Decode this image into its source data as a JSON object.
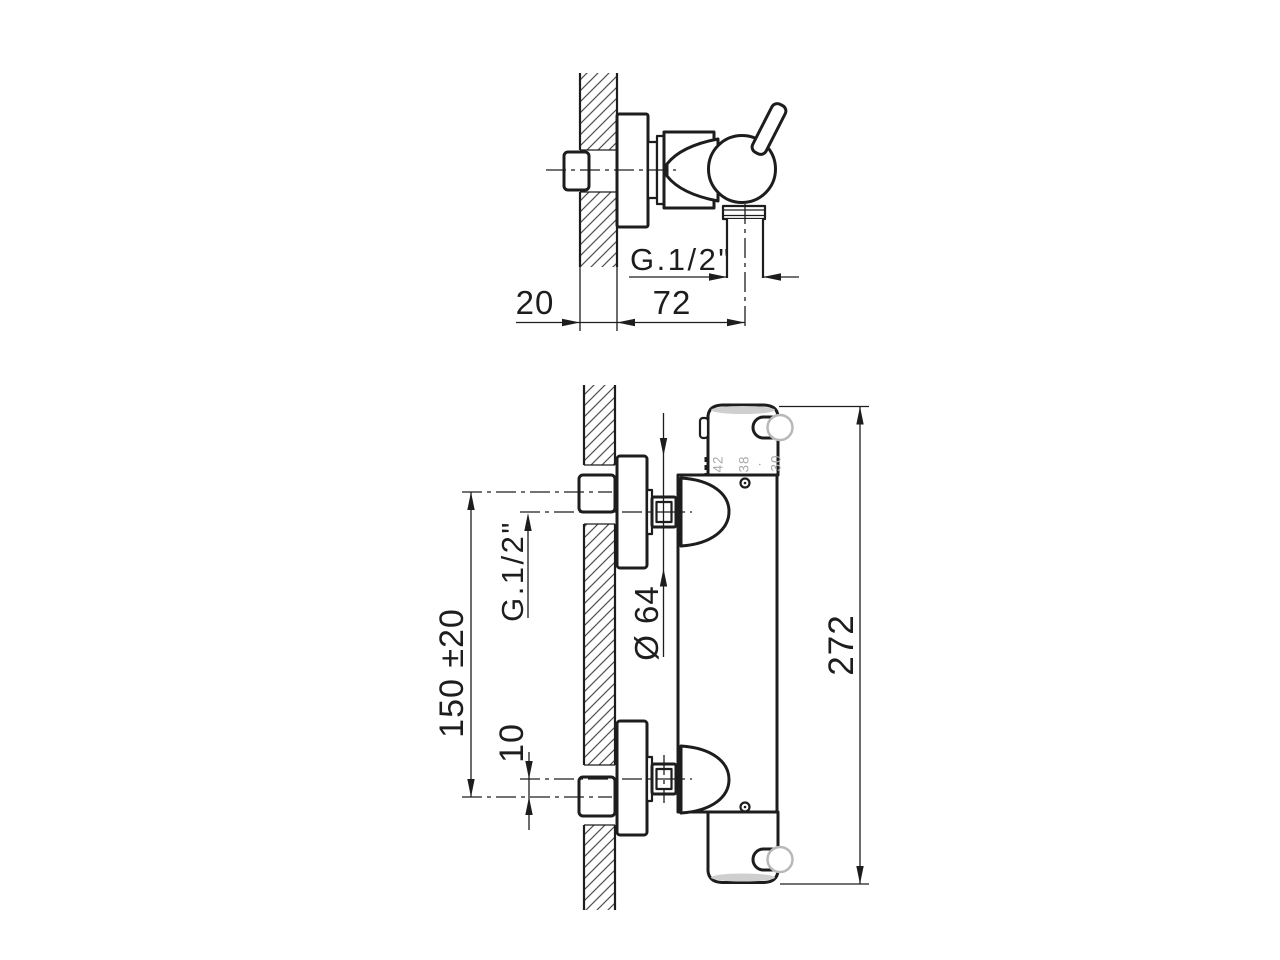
{
  "drawing": {
    "type": "technical-dimension-drawing",
    "subject": "wall-mounted thermostatic shower mixer",
    "background": "#ffffff",
    "line_color": "#1d1d1d",
    "gray_detail_color": "#a9a9a9",
    "side_view": {
      "dim_wall_thickness": "20",
      "dim_projection": "72",
      "outlet_thread_label": "G.1/2\""
    },
    "front_view": {
      "inlet_thread_label": "G.1/2\"",
      "dim_supply_spacing": "150 ±20",
      "dim_eccentric_offset": "10",
      "dim_escutcheon_diameter": "Ø 64",
      "dim_total_length": "272",
      "knob_scale_marks": [
        "42",
        "38",
        "·",
        "30"
      ]
    }
  }
}
